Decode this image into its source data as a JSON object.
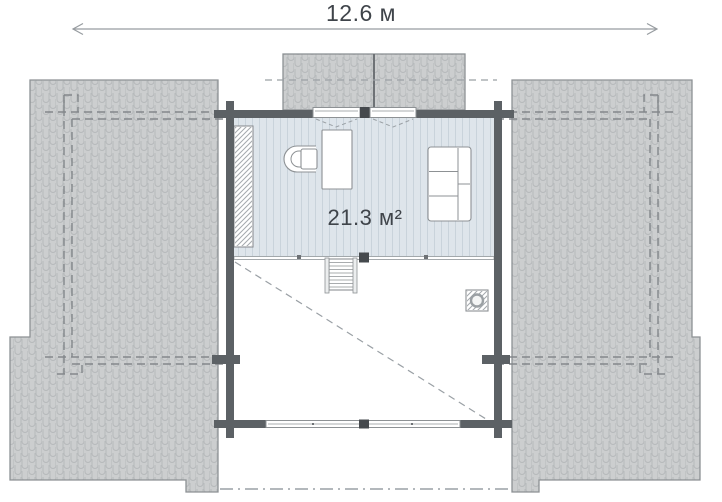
{
  "plan": {
    "overall_width_label": "12.6 м",
    "attic_room": {
      "area_label": "21.3 м²"
    }
  },
  "colors": {
    "roof_fill": "#cccecf",
    "roof_line": "#b6b9bb",
    "outline": "#8d9194",
    "wall": "#5c6165",
    "wall_dark": "#45494d",
    "floor_fill": "#dee5eb",
    "floor_stripe": "#c9d3db",
    "text": "#3f444a",
    "dash": "#9aa0a5",
    "white": "#ffffff"
  }
}
